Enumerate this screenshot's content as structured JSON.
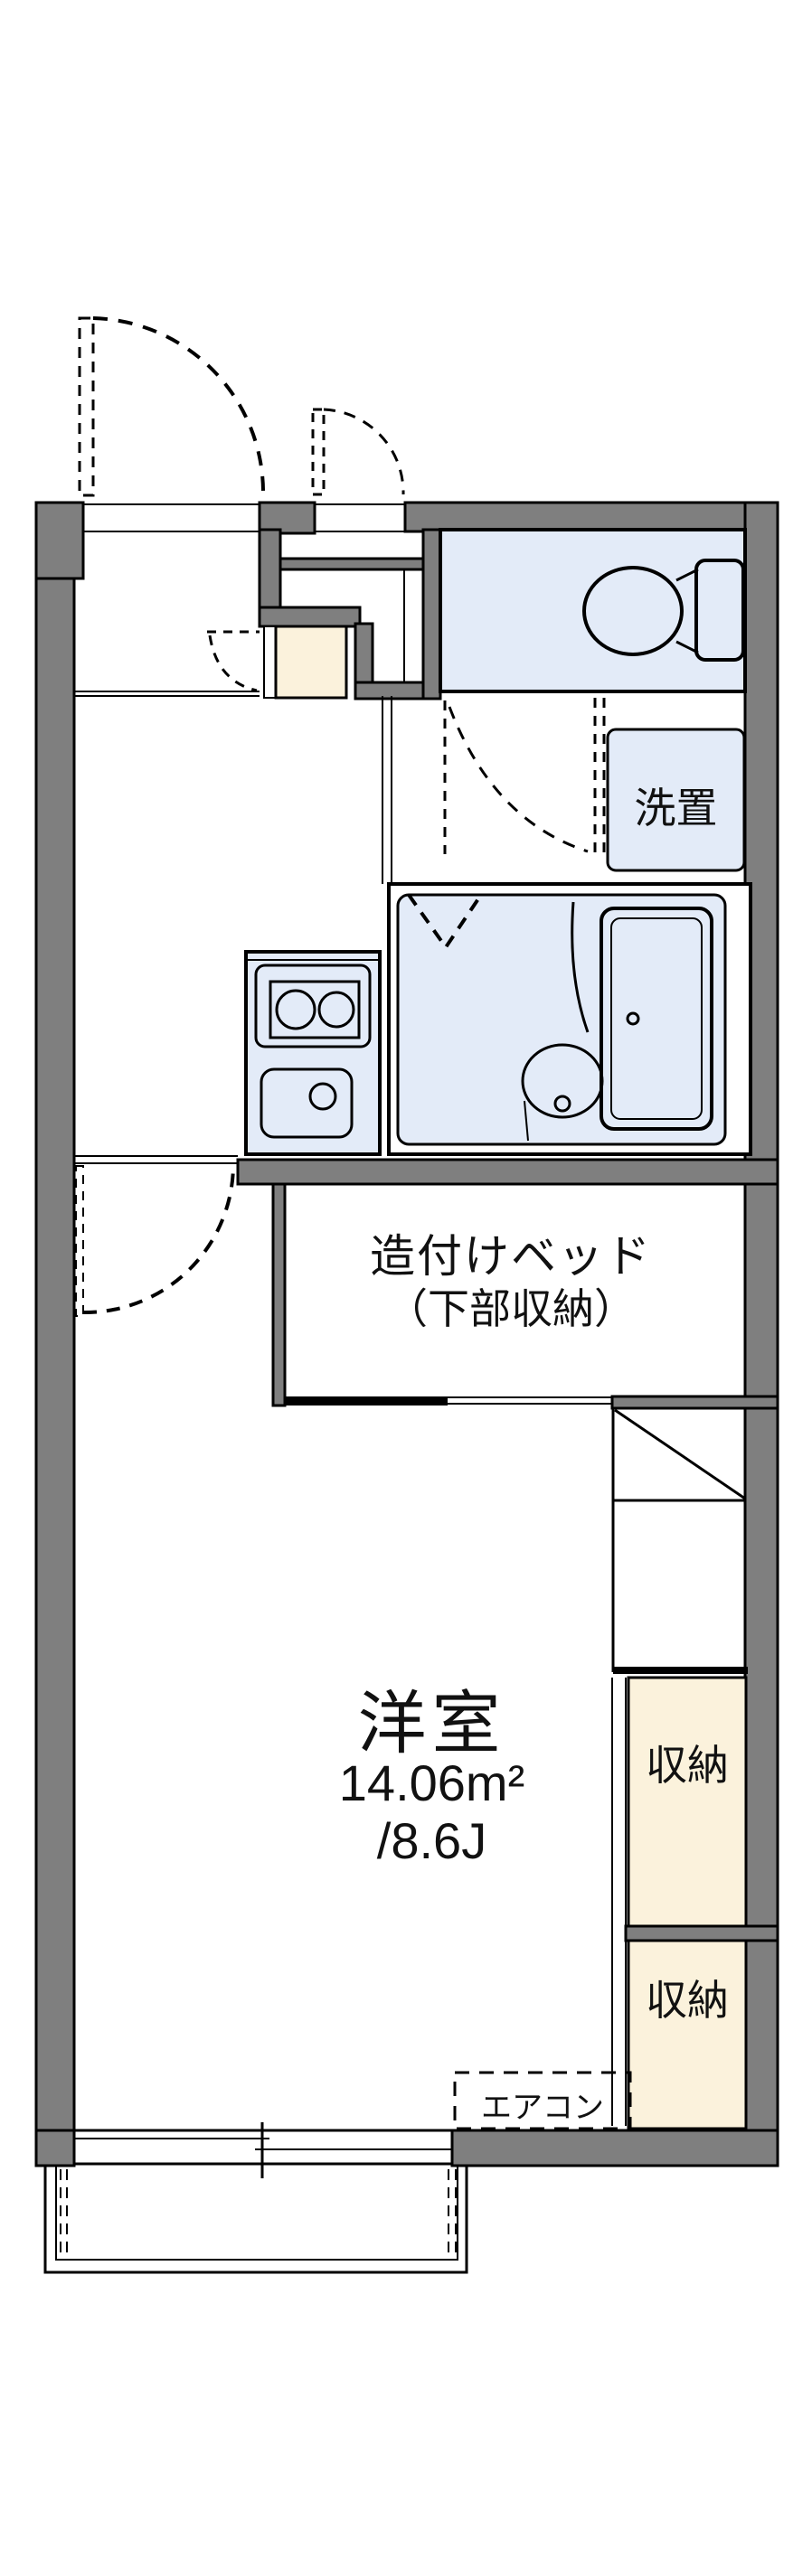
{
  "plan": {
    "type": "apartment-floor-plan",
    "colors": {
      "wall_gray": "#7f7f7f",
      "water_blue": "#e3ebf8",
      "tile_cream": "#fbf2dc",
      "line_black": "#000000"
    },
    "rooms": {
      "main_room": {
        "name": "洋室",
        "area_m2": "14.06m²",
        "area_jo": "/8.6J"
      },
      "built_in_bed": {
        "line1": "造付けベッド",
        "line2": "（下部収納）"
      },
      "laundry_space": {
        "label": "洗置"
      },
      "storage_upper": {
        "label": "収納"
      },
      "storage_lower": {
        "label": "収納"
      },
      "air_conditioner": {
        "label": "エアコン"
      }
    }
  }
}
